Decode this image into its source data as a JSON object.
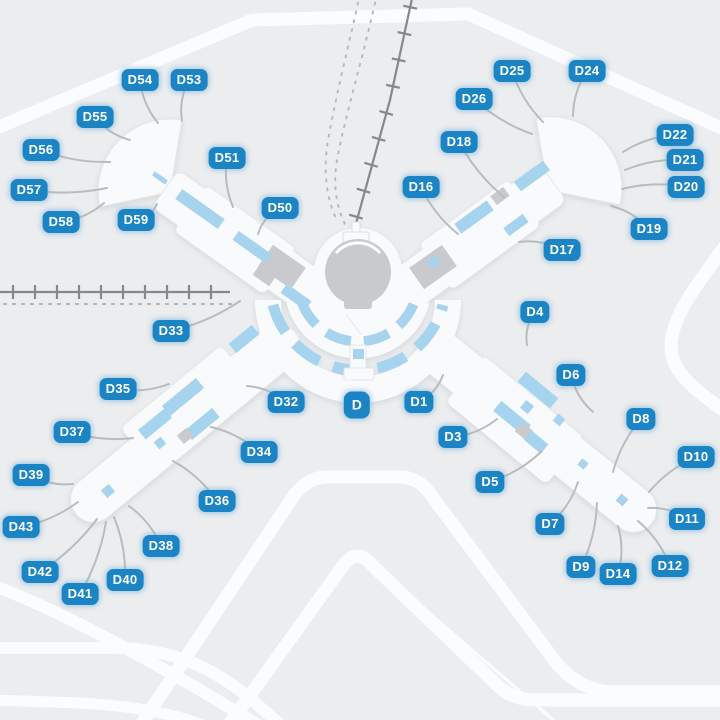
{
  "map": {
    "title": "Airport terminal gate map",
    "center_label": {
      "label": "D",
      "x": 357,
      "y": 405
    },
    "gates": [
      {
        "label": "D54",
        "x": 140,
        "y": 80,
        "lx": 158,
        "ly": 123
      },
      {
        "label": "D53",
        "x": 189,
        "y": 80,
        "lx": 182,
        "ly": 121
      },
      {
        "label": "D55",
        "x": 95,
        "y": 117,
        "lx": 130,
        "ly": 140
      },
      {
        "label": "D56",
        "x": 41,
        "y": 150,
        "lx": 110,
        "ly": 162
      },
      {
        "label": "D57",
        "x": 29,
        "y": 190,
        "lx": 107,
        "ly": 188
      },
      {
        "label": "D58",
        "x": 61,
        "y": 222,
        "lx": 104,
        "ly": 203
      },
      {
        "label": "D59",
        "x": 136,
        "y": 220,
        "lx": 157,
        "ly": 204
      },
      {
        "label": "D51",
        "x": 227,
        "y": 158,
        "lx": 233,
        "ly": 207
      },
      {
        "label": "D50",
        "x": 280,
        "y": 208,
        "lx": 258,
        "ly": 234
      },
      {
        "label": "D33",
        "x": 171,
        "y": 331,
        "lx": 240,
        "ly": 301
      },
      {
        "label": "D35",
        "x": 118,
        "y": 389,
        "lx": 169,
        "ly": 384
      },
      {
        "label": "D37",
        "x": 72,
        "y": 432,
        "lx": 133,
        "ly": 438
      },
      {
        "label": "D39",
        "x": 31,
        "y": 475,
        "lx": 73,
        "ly": 484
      },
      {
        "label": "D43",
        "x": 21,
        "y": 527,
        "lx": 78,
        "ly": 502
      },
      {
        "label": "D42",
        "x": 40,
        "y": 572,
        "lx": 97,
        "ly": 519
      },
      {
        "label": "D41",
        "x": 80,
        "y": 594,
        "lx": 106,
        "ly": 522
      },
      {
        "label": "D40",
        "x": 125,
        "y": 580,
        "lx": 114,
        "ly": 517
      },
      {
        "label": "D38",
        "x": 161,
        "y": 546,
        "lx": 129,
        "ly": 506
      },
      {
        "label": "D36",
        "x": 217,
        "y": 501,
        "lx": 173,
        "ly": 461
      },
      {
        "label": "D34",
        "x": 259,
        "y": 452,
        "lx": 211,
        "ly": 427
      },
      {
        "label": "D32",
        "x": 286,
        "y": 402,
        "lx": 247,
        "ly": 386
      },
      {
        "label": "D25",
        "x": 512,
        "y": 71,
        "lx": 543,
        "ly": 122
      },
      {
        "label": "D24",
        "x": 587,
        "y": 71,
        "lx": 573,
        "ly": 116
      },
      {
        "label": "D26",
        "x": 474,
        "y": 99,
        "lx": 532,
        "ly": 134
      },
      {
        "label": "D22",
        "x": 675,
        "y": 135,
        "lx": 623,
        "ly": 152
      },
      {
        "label": "D21",
        "x": 685,
        "y": 160,
        "lx": 625,
        "ly": 170
      },
      {
        "label": "D20",
        "x": 686,
        "y": 187,
        "lx": 622,
        "ly": 189
      },
      {
        "label": "D19",
        "x": 649,
        "y": 229,
        "lx": 611,
        "ly": 206
      },
      {
        "label": "D18",
        "x": 459,
        "y": 142,
        "lx": 504,
        "ly": 197
      },
      {
        "label": "D16",
        "x": 421,
        "y": 187,
        "lx": 458,
        "ly": 234
      },
      {
        "label": "D17",
        "x": 562,
        "y": 250,
        "lx": 519,
        "ly": 242
      },
      {
        "label": "D4",
        "x": 535,
        "y": 312,
        "lx": 527,
        "ly": 345
      },
      {
        "label": "D6",
        "x": 571,
        "y": 375,
        "lx": 593,
        "ly": 412
      },
      {
        "label": "D1",
        "x": 419,
        "y": 402,
        "lx": 443,
        "ly": 375
      },
      {
        "label": "D3",
        "x": 453,
        "y": 437,
        "lx": 497,
        "ly": 419
      },
      {
        "label": "D8",
        "x": 641,
        "y": 419,
        "lx": 613,
        "ly": 472
      },
      {
        "label": "D5",
        "x": 490,
        "y": 482,
        "lx": 542,
        "ly": 451
      },
      {
        "label": "D10",
        "x": 696,
        "y": 457,
        "lx": 649,
        "ly": 492
      },
      {
        "label": "D7",
        "x": 550,
        "y": 524,
        "lx": 578,
        "ly": 482
      },
      {
        "label": "D11",
        "x": 687,
        "y": 519,
        "lx": 648,
        "ly": 508
      },
      {
        "label": "D9",
        "x": 581,
        "y": 567,
        "lx": 597,
        "ly": 503
      },
      {
        "label": "D14",
        "x": 618,
        "y": 574,
        "lx": 618,
        "ly": 526
      },
      {
        "label": "D12",
        "x": 670,
        "y": 566,
        "lx": 638,
        "ly": 521
      }
    ]
  },
  "colors": {
    "background": "#ebedef",
    "road": "#fbfcfd",
    "terminal_fill": "#f8fafb",
    "terminal_outline": "#e4e7e9",
    "concourse_blue": "#a6d3ee",
    "building_gray": "#c8cacd",
    "label_blue": "#1a84c4",
    "label_text": "#ffffff",
    "leader_line": "#b9bbbd",
    "railway": "#85888c"
  }
}
